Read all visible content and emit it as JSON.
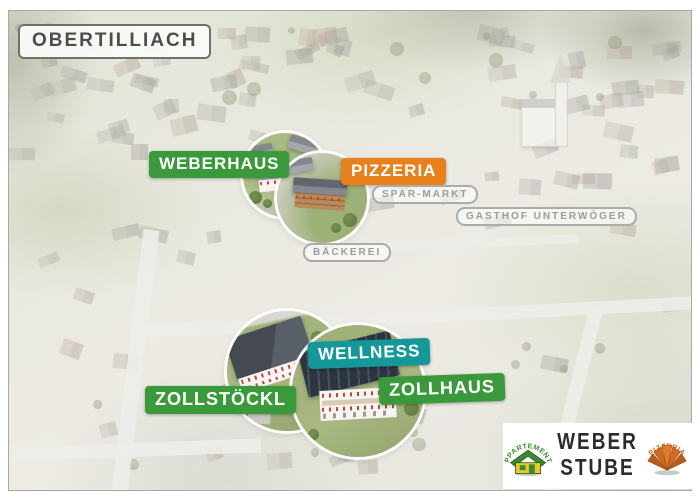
{
  "title": {
    "label": "OBERTILLIACH"
  },
  "markers": [
    {
      "id": "weberhaus",
      "label": "WEBERHAUS",
      "style": "green"
    },
    {
      "id": "pizzeria",
      "label": "PIZZERIA",
      "style": "orange"
    },
    {
      "id": "spar-markt",
      "label": "SPAR-MARKT",
      "style": "outline"
    },
    {
      "id": "gasthof-unterwoeger",
      "label": "GASTHOF UNTERWÖGER",
      "style": "outline"
    },
    {
      "id": "baeckerei",
      "label": "BÄCKEREI",
      "style": "outline"
    },
    {
      "id": "wellness",
      "label": "WELLNESS",
      "style": "teal"
    },
    {
      "id": "zollhaus",
      "label": "ZOLLHAUS",
      "style": "green"
    },
    {
      "id": "zollstoeckl",
      "label": "ZOLLSTÖCKL",
      "style": "green"
    }
  ],
  "logo": {
    "appartements": "APPARTEMENTS",
    "brand_top": "WEBER",
    "brand_bottom": "STUBE",
    "pizzeria": "PIZZERIA"
  },
  "colors": {
    "marker_green": "#3a9a3b",
    "marker_orange": "#e8811c",
    "marker_teal": "#16989a",
    "marker_outline_gray": "#9c9c9c",
    "logo_green": "#3d8a2f",
    "logo_orange": "#d2691e"
  }
}
